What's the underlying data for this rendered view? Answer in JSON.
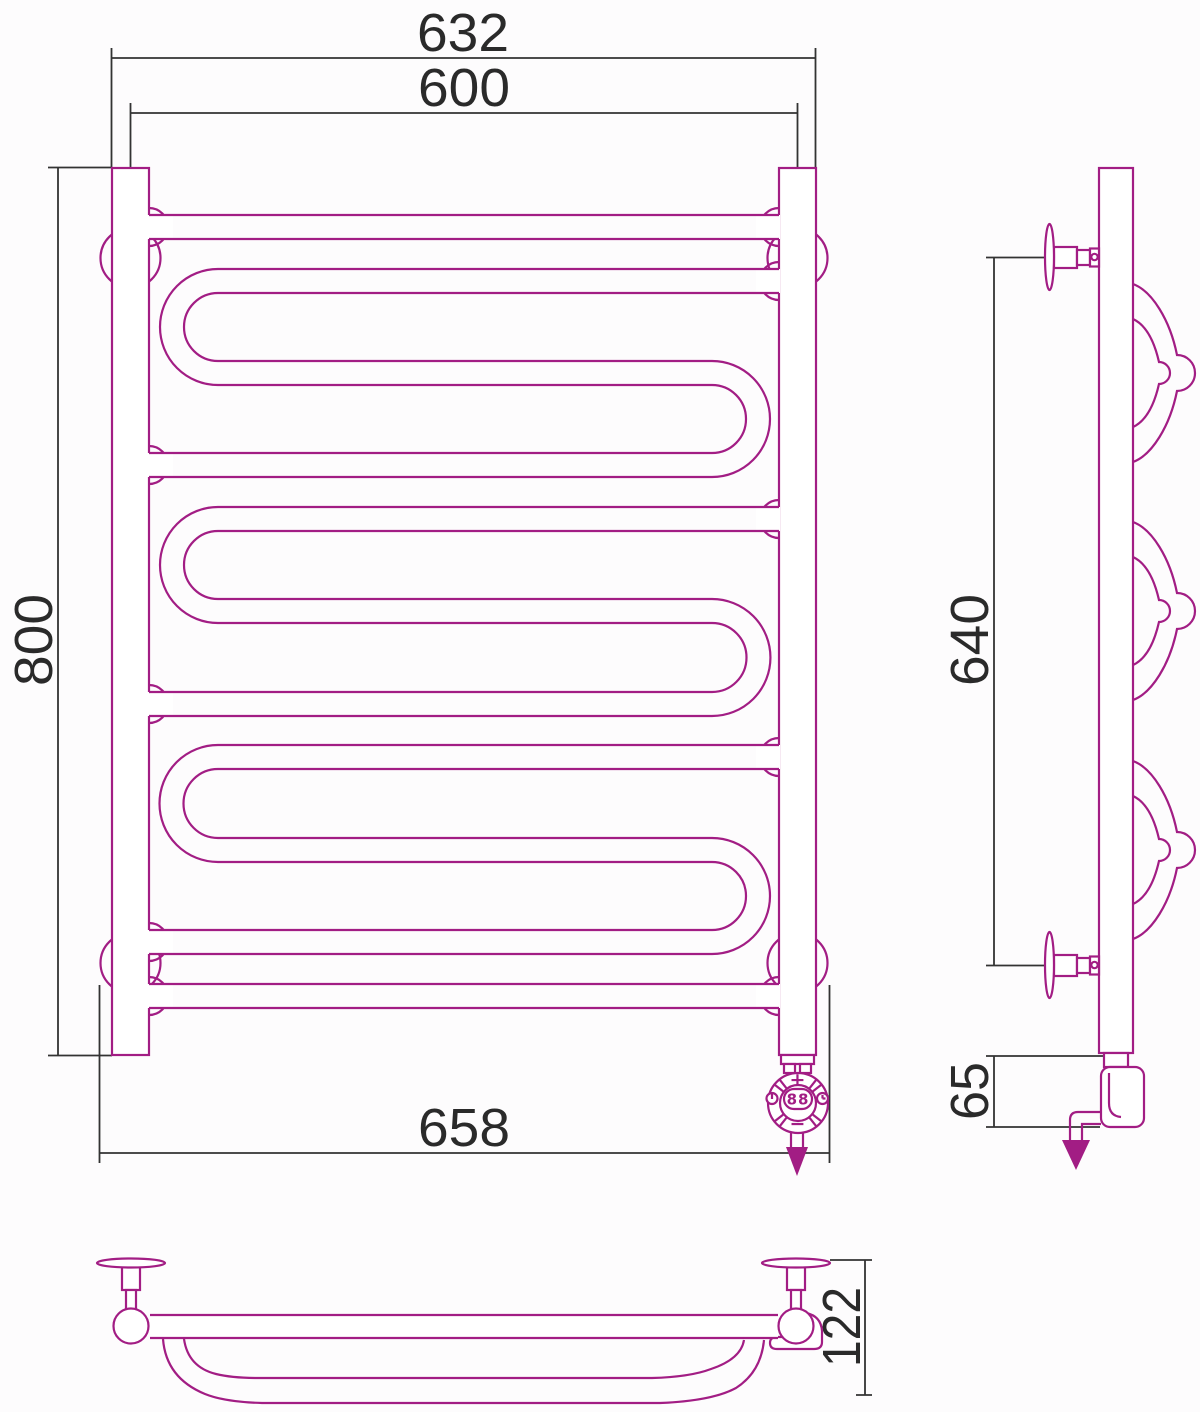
{
  "drawing": {
    "title_semantic": "heated-towel-rail-technical-drawing",
    "dimensions": {
      "front_width_outer": "632",
      "front_width_centers": "600",
      "front_height": "800",
      "front_width_brackets": "658",
      "side_bracket_span": "640",
      "side_heater_height": "65",
      "plan_depth": "122"
    },
    "control_unit": {
      "plus_label": "+",
      "minus_label": "−",
      "display_value": "88"
    },
    "colors": {
      "product": "#A21D84",
      "dimension": "#333333",
      "background": "#fdfcfd"
    }
  }
}
